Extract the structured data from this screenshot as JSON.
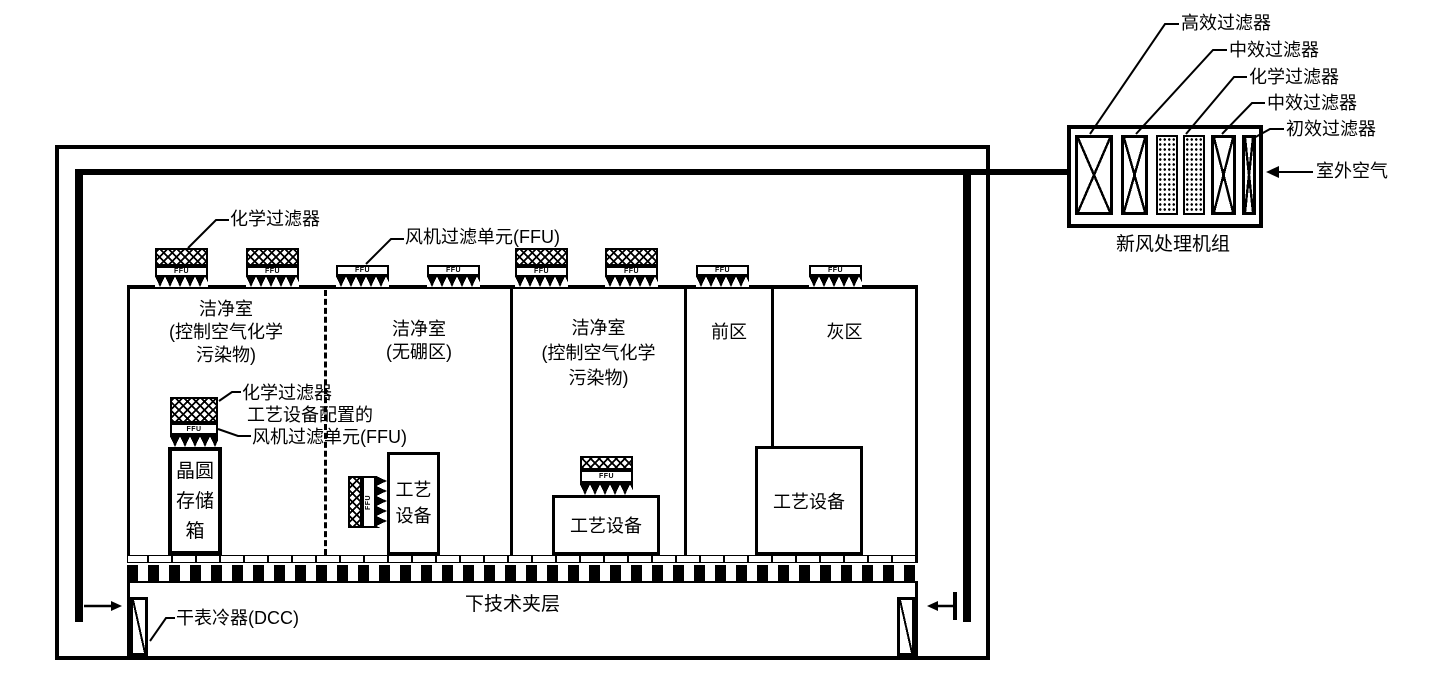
{
  "fresh_air_unit": {
    "caption": "新风处理机组",
    "filters": [
      "高效过滤器",
      "中效过滤器",
      "化学过滤器",
      "中效过滤器",
      "初效过滤器"
    ],
    "outdoor_air": "室外空气"
  },
  "ffu_unit_text": "FFU",
  "ceiling": {
    "chemical_filter": "化学过滤器",
    "fan_filter_unit": "风机过滤单元(FFU)"
  },
  "rooms": {
    "cleanroom_left": {
      "line1": "洁净室",
      "line2": "(控制空气化学",
      "line3": "污染物)"
    },
    "cleanroom_boron_free": {
      "line1": "洁净室",
      "line2": "(无硼区)"
    },
    "cleanroom_right": {
      "line1": "洁净室",
      "line2": "(控制空气化学",
      "line3": "污染物)"
    },
    "front_zone": "前区",
    "gray_zone": "灰区"
  },
  "wafer_storage": {
    "line1": "晶圆",
    "line2": "存储",
    "line3": "箱"
  },
  "tool_ffu": {
    "chemical_filter": "化学过滤器",
    "label_line1": "工艺设备配置的",
    "label_line2": "风机过滤单元(FFU)"
  },
  "equipment": {
    "boron_room_line1": "工艺",
    "boron_room_line2": "设备",
    "cleanroom_right": "工艺设备",
    "gray_zone": "工艺设备"
  },
  "plenum": {
    "label": "下技术夹层",
    "dcc": "干表冷器(DCC)"
  }
}
